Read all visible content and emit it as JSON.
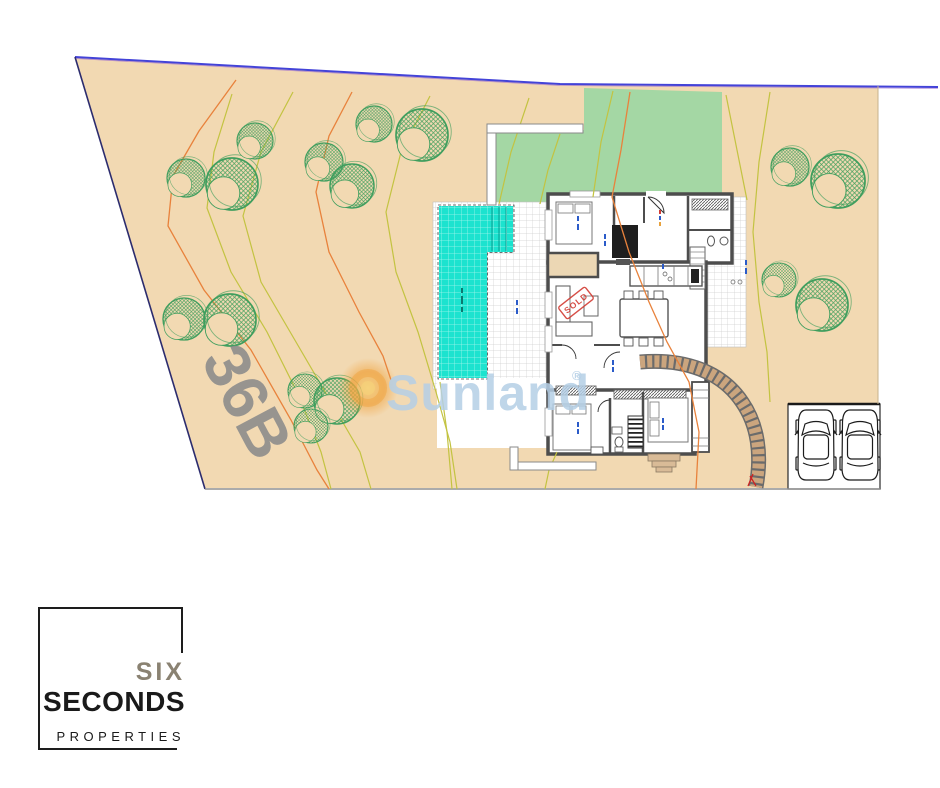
{
  "plan": {
    "plot_number": "36B",
    "watermark": {
      "brand": "Sunland",
      "registered_mark": "®"
    },
    "sold_stamp": "SOLD",
    "colors": {
      "plot_fill": "#f2d9b2",
      "lawn_fill": "#a4d7a4",
      "pool_fill": "#1ce3cf",
      "tree_green": "#3f9e5e",
      "boundary_blue": "#4343d8",
      "boundary_dark": "#2c2c6e",
      "contour_yellow": "#c3c341",
      "contour_orange": "#e8823c",
      "wall_gray": "#4d4d4d",
      "paver_tan": "#cba57e",
      "stamp_red": "#d23b33",
      "watermark_blue": "#b5cfe6",
      "plot_number_gray": "#8b8b8b"
    }
  },
  "logo": {
    "word1": "SIX",
    "word2": "SECONDS",
    "word3": "PROPERTIES"
  }
}
